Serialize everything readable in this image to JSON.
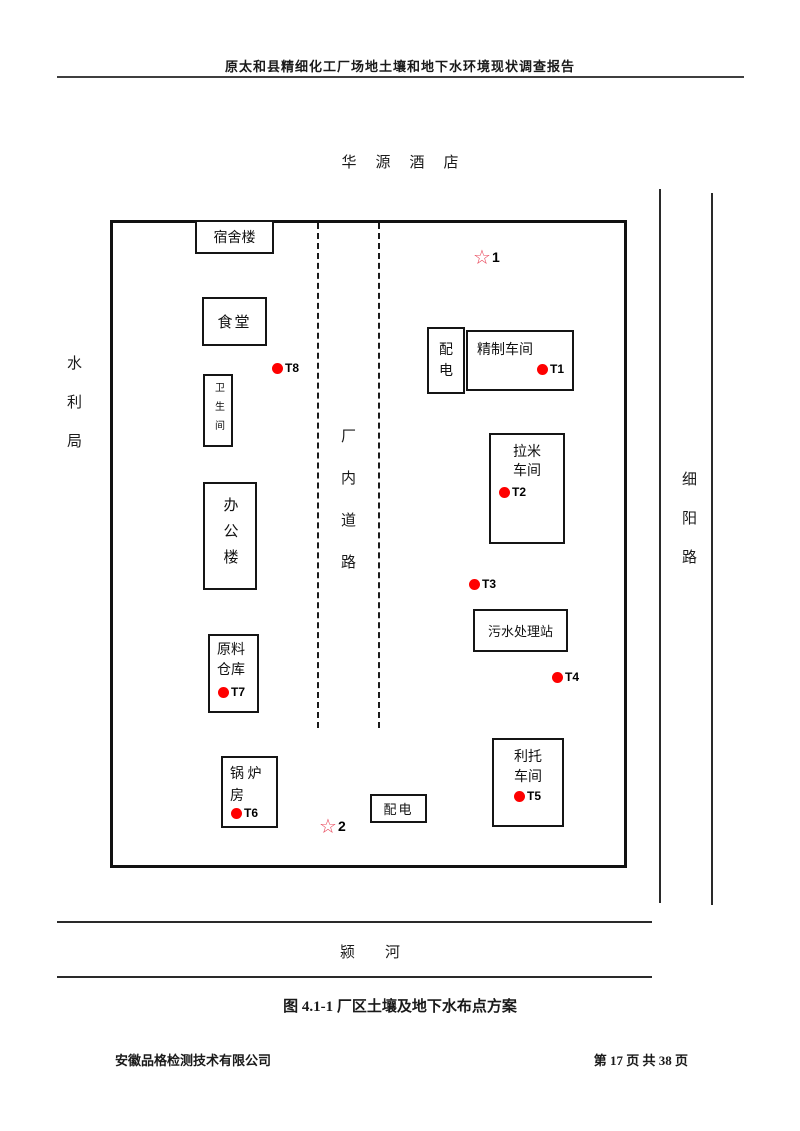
{
  "page": {
    "header_title": "原太和县精细化工厂场地土壤和地下水环境现状调查报告",
    "figure_caption": "图 4.1-1 厂区土壤及地下水布点方案",
    "footer": {
      "company": "安徽品格检测技术有限公司",
      "page_info": "第 17 页 共 38 页"
    }
  },
  "surroundings": {
    "north_label": "华源酒店",
    "west_label": "水利局",
    "east_label": "细阳路",
    "south_label": "颍河"
  },
  "site_plan": {
    "road_label": "厂内道路",
    "buildings": {
      "dormitory": "宿舍楼",
      "canteen": "食堂",
      "toilet": "卫生间",
      "office": "办公楼",
      "material_warehouse": "原料\n仓库",
      "boiler_room": "锅 炉\n房",
      "power_distribution_top": "配\n电",
      "refining_workshop": "精制车间",
      "lami_workshop": "拉米\n车间",
      "sewage_station": "污水处理站",
      "lituo_workshop": "利托\n车间",
      "power_distribution_bottom": "配电"
    },
    "soil_points": {
      "t1": "T1",
      "t2": "T2",
      "t3": "T3",
      "t4": "T4",
      "t5": "T5",
      "t6": "T6",
      "t7": "T7",
      "t8": "T8"
    },
    "groundwater_points": {
      "star_glyph": "☆",
      "p1": "1",
      "p2": "2"
    },
    "colors": {
      "sample_dot": "#fe0000",
      "star_outline": "#e8465a"
    }
  }
}
